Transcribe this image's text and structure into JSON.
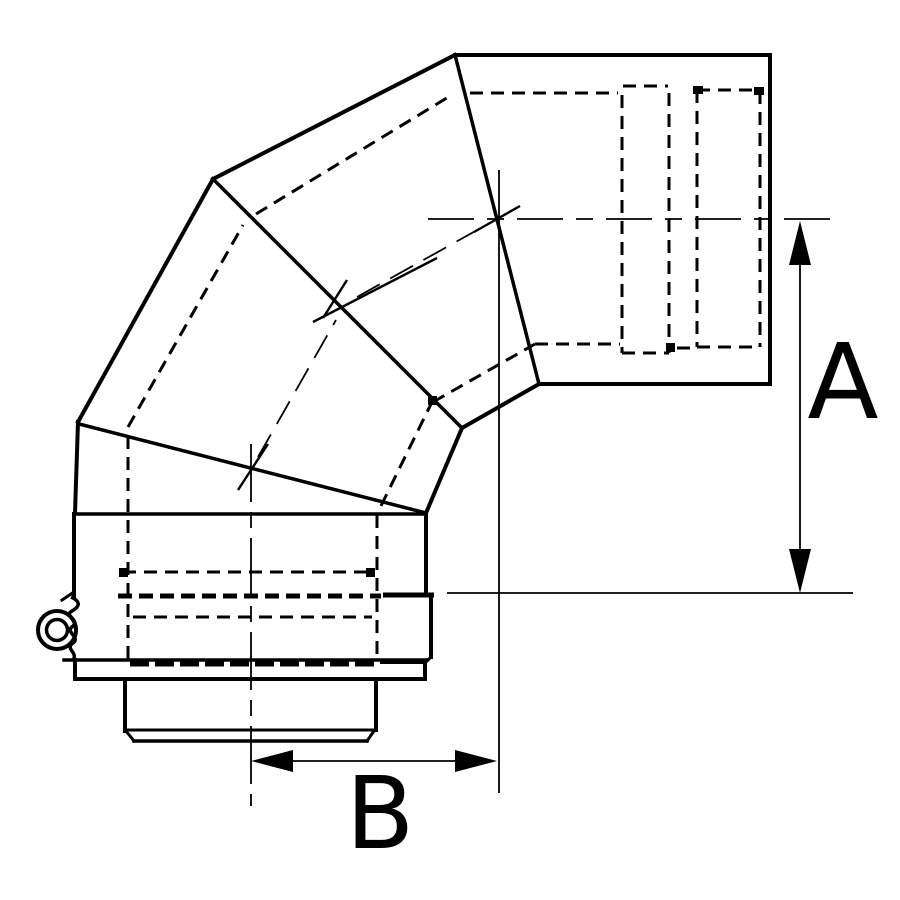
{
  "drawing": {
    "background": "#ffffff",
    "line_color": "#000000",
    "labels": {
      "dimension_a": "A",
      "dimension_b": "B"
    }
  }
}
